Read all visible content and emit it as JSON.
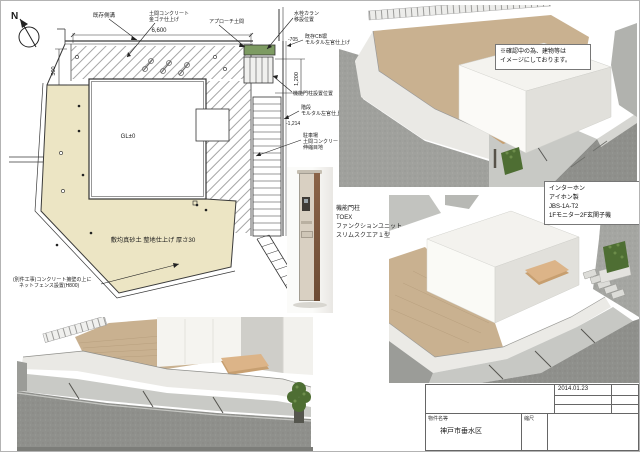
{
  "colors": {
    "paper": "#ffffff",
    "plan_ground": "#ece5c4",
    "plan_line": "#3a3a3a",
    "planter_green": "#7d9b62",
    "road_dark": "#8f908c",
    "road_mid": "#a0a19d",
    "concrete": "#c8c9c5",
    "wall_white": "#eae9e5",
    "yard_tan": "#c9b190",
    "deck_wood": "#c79f70",
    "building_lit": "#f7f6f2",
    "building_shade": "#e1e0db",
    "hedge_green": "#4e6e33"
  },
  "plan": {
    "north": "N",
    "dims": {
      "top": "6,600",
      "left": "500",
      "right": "1,200"
    },
    "levels": {
      "a": "-705",
      "b": "-1,214",
      "c": "-1,416"
    },
    "center_level": "GL±0",
    "ground_note": "敷均真砂土 整地仕上げ 厚さ30",
    "labels": {
      "boundary": "既存側溝",
      "doma1": "土間コンクリート",
      "doma2": "金ゴテ仕上げ",
      "approach": "アプローチ土間",
      "water1": "水栓カラン",
      "water2": "移設位置",
      "wall1": "既存CB塀",
      "wall2": "モルタル左官仕上げ",
      "gate": "機能門柱設置位置",
      "stair1": "階段",
      "stair2": "モルタル左官仕上げ",
      "park1": "駐車場",
      "park2": "土間コンクリート",
      "park3": "伸縮目地",
      "fence1": "(別件工事)コンクリート擁壁の上に",
      "fence2": "ネットフェンス設置(H800)"
    }
  },
  "product": {
    "name": "機能門柱",
    "brand": "TOEX",
    "series": "ファンクションユニット",
    "model": "スリムスクエア１型"
  },
  "interphone": {
    "title": "インターホン",
    "maker": "アイホン製",
    "model": "JBS-1A-T2",
    "note": "1Fモニター2F玄関子機"
  },
  "render_note": {
    "line1": "※確認中の為、建物等は",
    "line2": "イメージにしております。"
  },
  "titleblock": {
    "date": "2014.01.23",
    "project_label": "物件名等",
    "project_value": "神戸市垂水区",
    "scale_label": "縮尺"
  }
}
